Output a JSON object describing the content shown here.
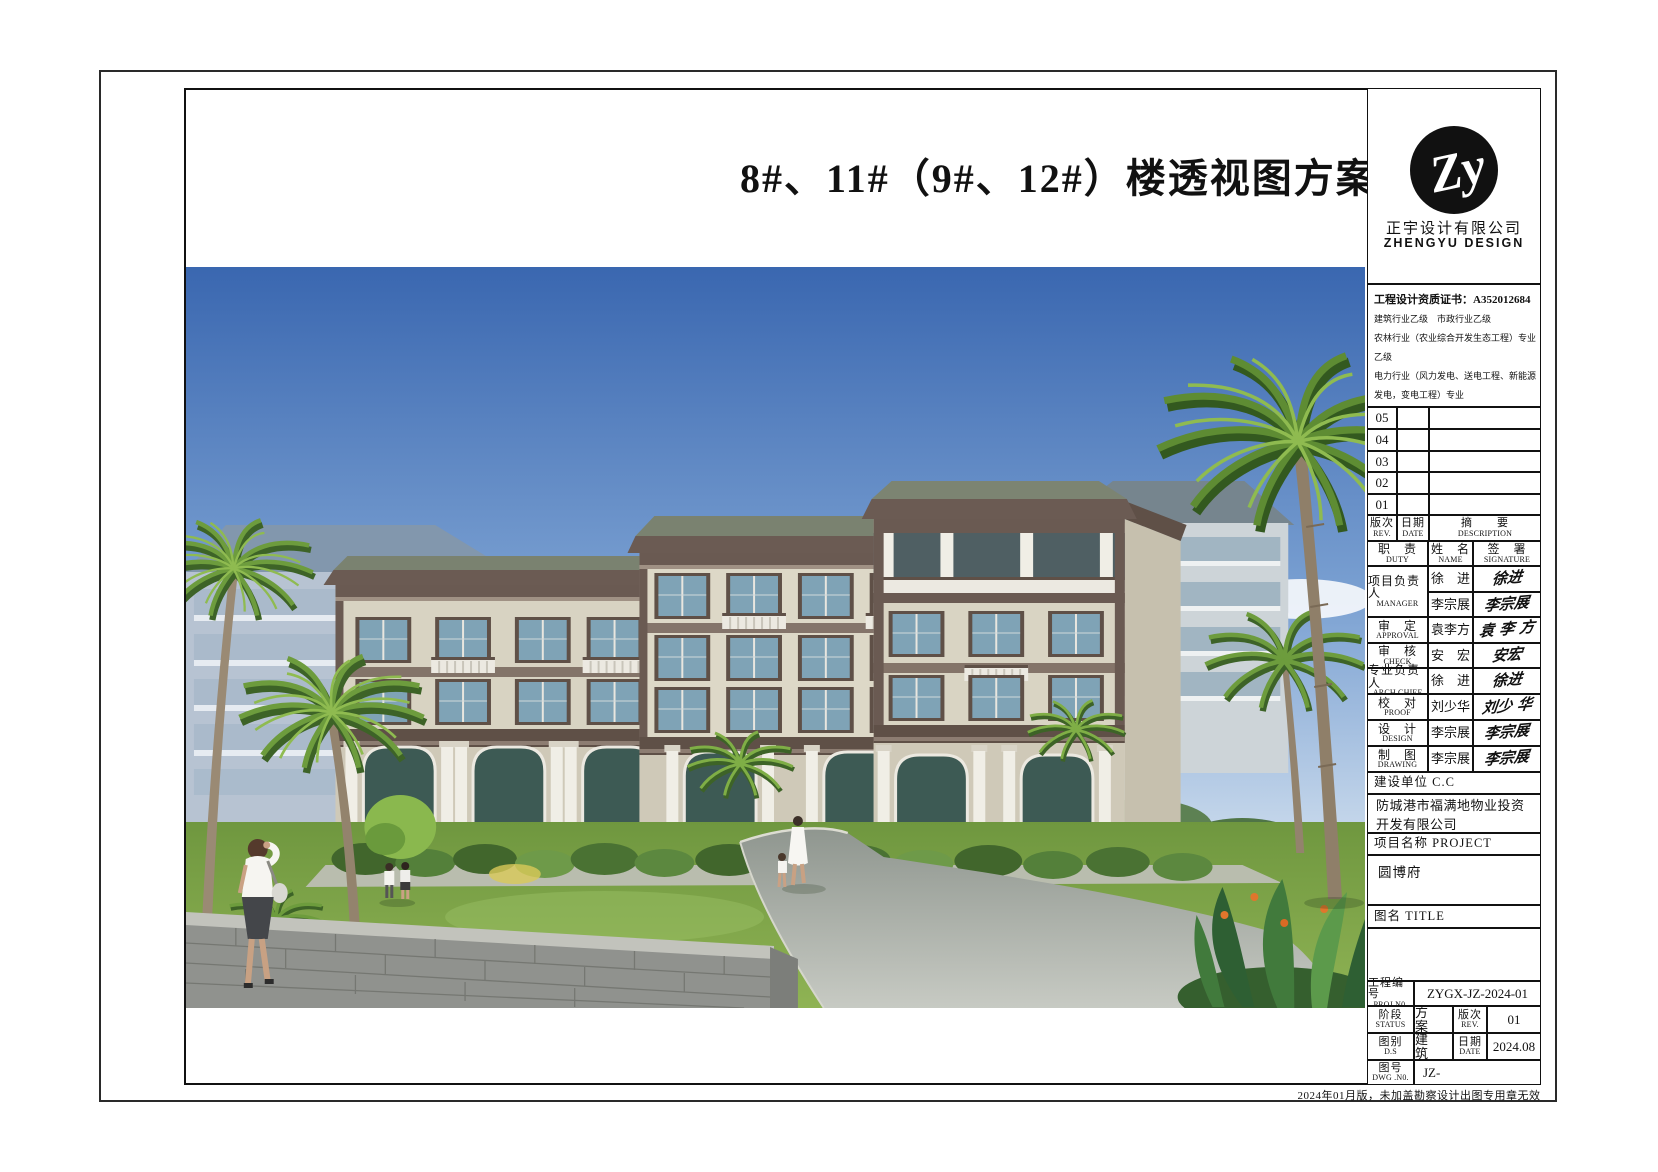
{
  "page": {
    "footer_note": "2024年01月版，未加盖勘察设计出图专用章无效"
  },
  "drawing": {
    "title": "8#、11#（9#、12#）楼透视图方案一"
  },
  "palette": {
    "sky_top": "#3a67b0",
    "sky_horizon": "#d8e5f0",
    "wall_cream": "#d9d4c3",
    "trim_brown": "#5e4f49",
    "roof_slate": "#7b8373",
    "glass_blue": "#86a7ba",
    "foliage": "#57823a",
    "lawn": "#7ba04a",
    "road": "#a8adaa",
    "stone_wall": "#90928e"
  },
  "title_block": {
    "logo": {
      "monogram": "Zy",
      "company_cn": "正宇设计有限公司",
      "company_en": "ZHENGYU DESIGN"
    },
    "certificate_lines": [
      "工程设计资质证书：A352012684",
      "建筑行业乙级　市政行业乙级",
      "农林行业（农业综合开发生态工程）专业乙级",
      "电力行业（风力发电、送电工程、新能源发电，变电工程）专业",
      "化工石油医药（石油及化工产品储运、化工矿山、炼油工程、",
      "化工工程）专业乙级"
    ],
    "rev": {
      "rows": [
        "05",
        "04",
        "03",
        "02",
        "01"
      ],
      "header": {
        "rev_cn": "版次",
        "rev_en": "REV.",
        "date_cn": "日期",
        "date_en": "DATE",
        "desc_cn": "摘　　要",
        "desc_en": "DESCRIPTION"
      }
    },
    "duty": {
      "header": {
        "duty_cn": "职　责",
        "duty_en": "DUTY",
        "name_cn": "姓　名",
        "name_en": "NAME",
        "sig_cn": "签　署",
        "sig_en": "SIGNATURE"
      },
      "rows": [
        {
          "duty_cn": "项目负责人",
          "duty_en": "MANAGER",
          "names": [
            "徐　进",
            "李宗展"
          ],
          "sigs": [
            "徐进",
            "李宗展"
          ]
        },
        {
          "duty_cn": "审　定",
          "duty_en": "APPROVAL",
          "names": [
            "袁李方"
          ],
          "sigs": [
            "袁 李 方"
          ]
        },
        {
          "duty_cn": "审　核",
          "duty_en": "CHECK",
          "names": [
            "安　宏"
          ],
          "sigs": [
            "安宏"
          ]
        },
        {
          "duty_cn": "专业负责人",
          "duty_en": "ARCH.CHIEF",
          "names": [
            "徐　进"
          ],
          "sigs": [
            "徐进"
          ]
        },
        {
          "duty_cn": "校　对",
          "duty_en": "PROOF",
          "names": [
            "刘少华"
          ],
          "sigs": [
            "刘少 华"
          ]
        },
        {
          "duty_cn": "设　计",
          "duty_en": "DESIGN",
          "names": [
            "李宗展"
          ],
          "sigs": [
            "李宗展"
          ]
        },
        {
          "duty_cn": "制　图",
          "duty_en": "DRAWING",
          "names": [
            "李宗展"
          ],
          "sigs": [
            "李宗展"
          ]
        }
      ]
    },
    "client": {
      "label": "建设单位  C.C",
      "value": "防城港市福满地物业投资开发有限公司"
    },
    "project": {
      "label": "项目名称  PROJECT",
      "value": "圆博府"
    },
    "title_label": "图名  TITLE",
    "proj_no": {
      "label_cn": "工程编号",
      "label_en": "PROJ.N0.",
      "value": "ZYGX-JZ-2024-01"
    },
    "status": {
      "label_cn": "阶段",
      "label_en": "STATUS",
      "value": "方　案",
      "rev_cn": "版次",
      "rev_en": "REV.",
      "rev_value": "01"
    },
    "category": {
      "label_cn": "图别",
      "label_en": "D.S",
      "value": "建　筑",
      "date_cn": "日期",
      "date_en": "DATE",
      "date_value": "2024.08"
    },
    "dwg_no": {
      "label_cn": "图号",
      "label_en": "DWG .N0.",
      "value": "JZ-"
    }
  }
}
